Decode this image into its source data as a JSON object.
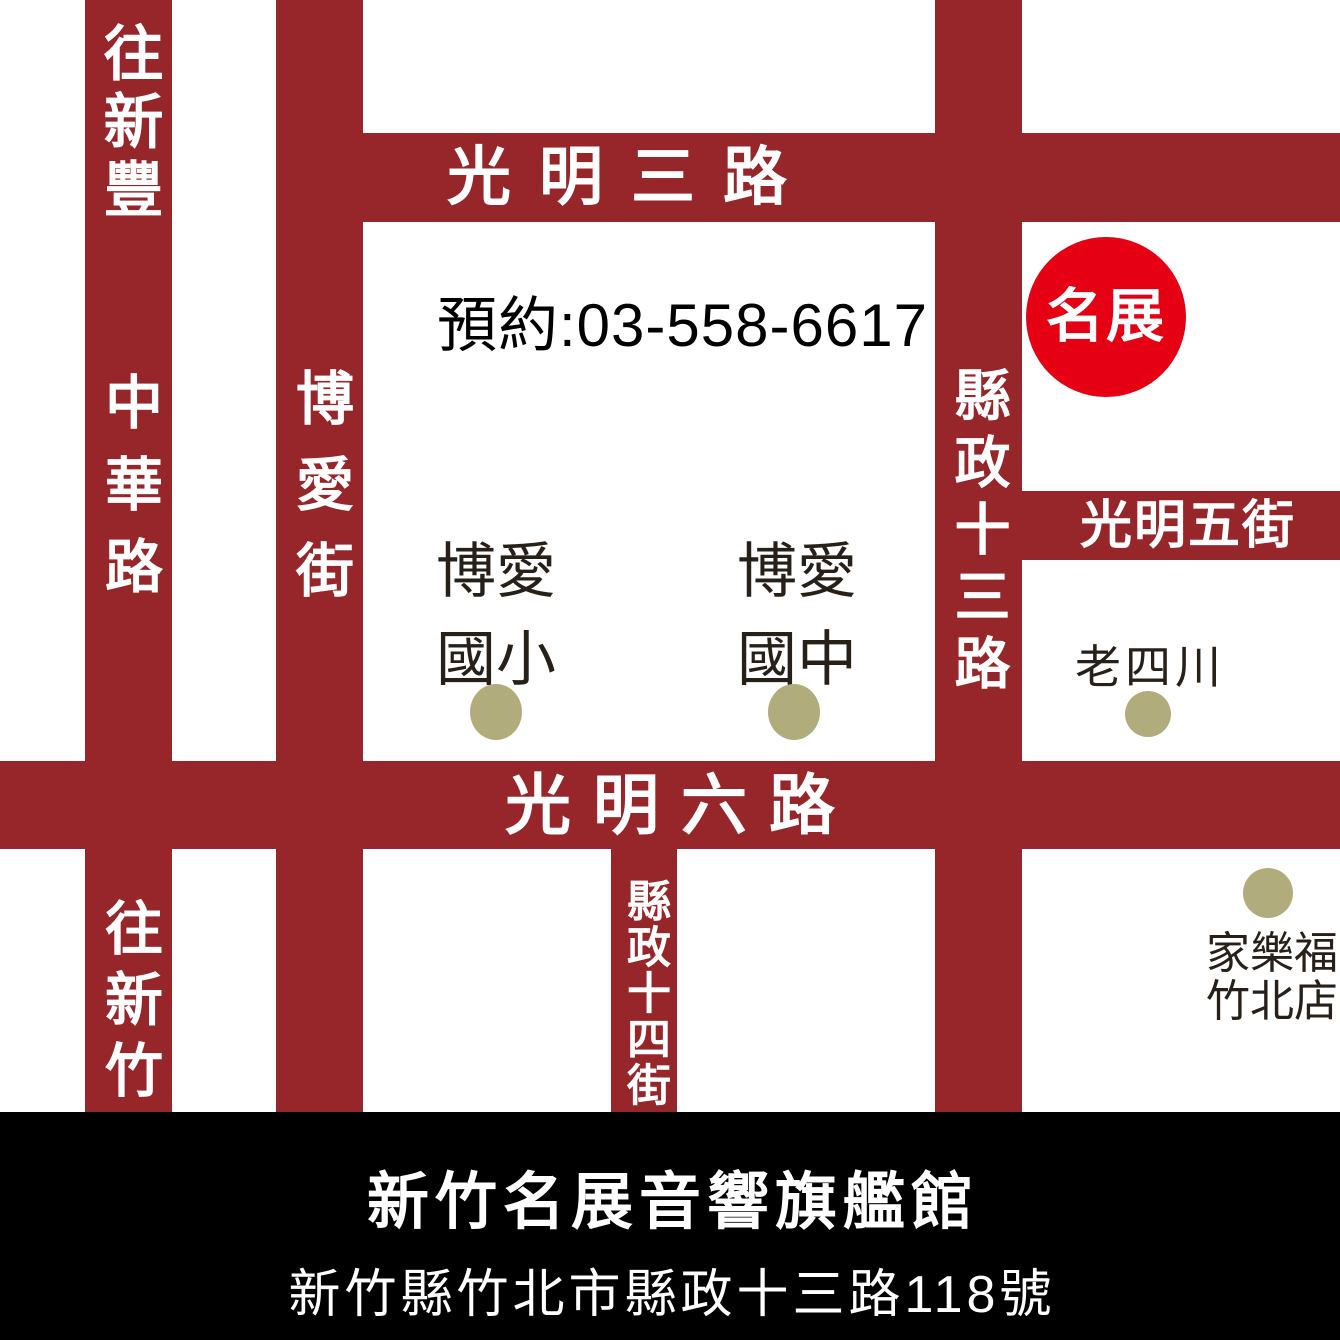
{
  "colors": {
    "road": "#96262a",
    "road_text": "#ffffff",
    "circle": "#e60014",
    "dot": "#b1ac7b",
    "footer_bg": "#000000",
    "landmark_text": "#262019",
    "phone_text": "#000000"
  },
  "roads": {
    "zhonghua": {
      "to_top": "往新豐",
      "name": "中華路",
      "to_bottom": "往新竹"
    },
    "boai_street": {
      "name": "博愛街"
    },
    "guangming3": {
      "name": "光明三路"
    },
    "xianzheng13": {
      "name": "縣政十三路"
    },
    "guangming5": {
      "name": "光明五街"
    },
    "guangming6": {
      "name": "光明六路"
    },
    "xianzheng14": {
      "name": "縣政十四街"
    }
  },
  "phone": {
    "label": "預約:03-558-6617"
  },
  "store_marker": {
    "label": "名展"
  },
  "landmarks": {
    "boai_elementary": {
      "line1": "博愛",
      "line2": "國小"
    },
    "boai_junior_high": {
      "line1": "博愛",
      "line2": "國中"
    },
    "lao_si_chuan": {
      "name": "老四川"
    },
    "carrefour": {
      "line1": "家樂福",
      "line2": "竹北店"
    }
  },
  "footer": {
    "title": "新竹名展音響旗艦館",
    "address": "新竹縣竹北市縣政十三路118號"
  }
}
